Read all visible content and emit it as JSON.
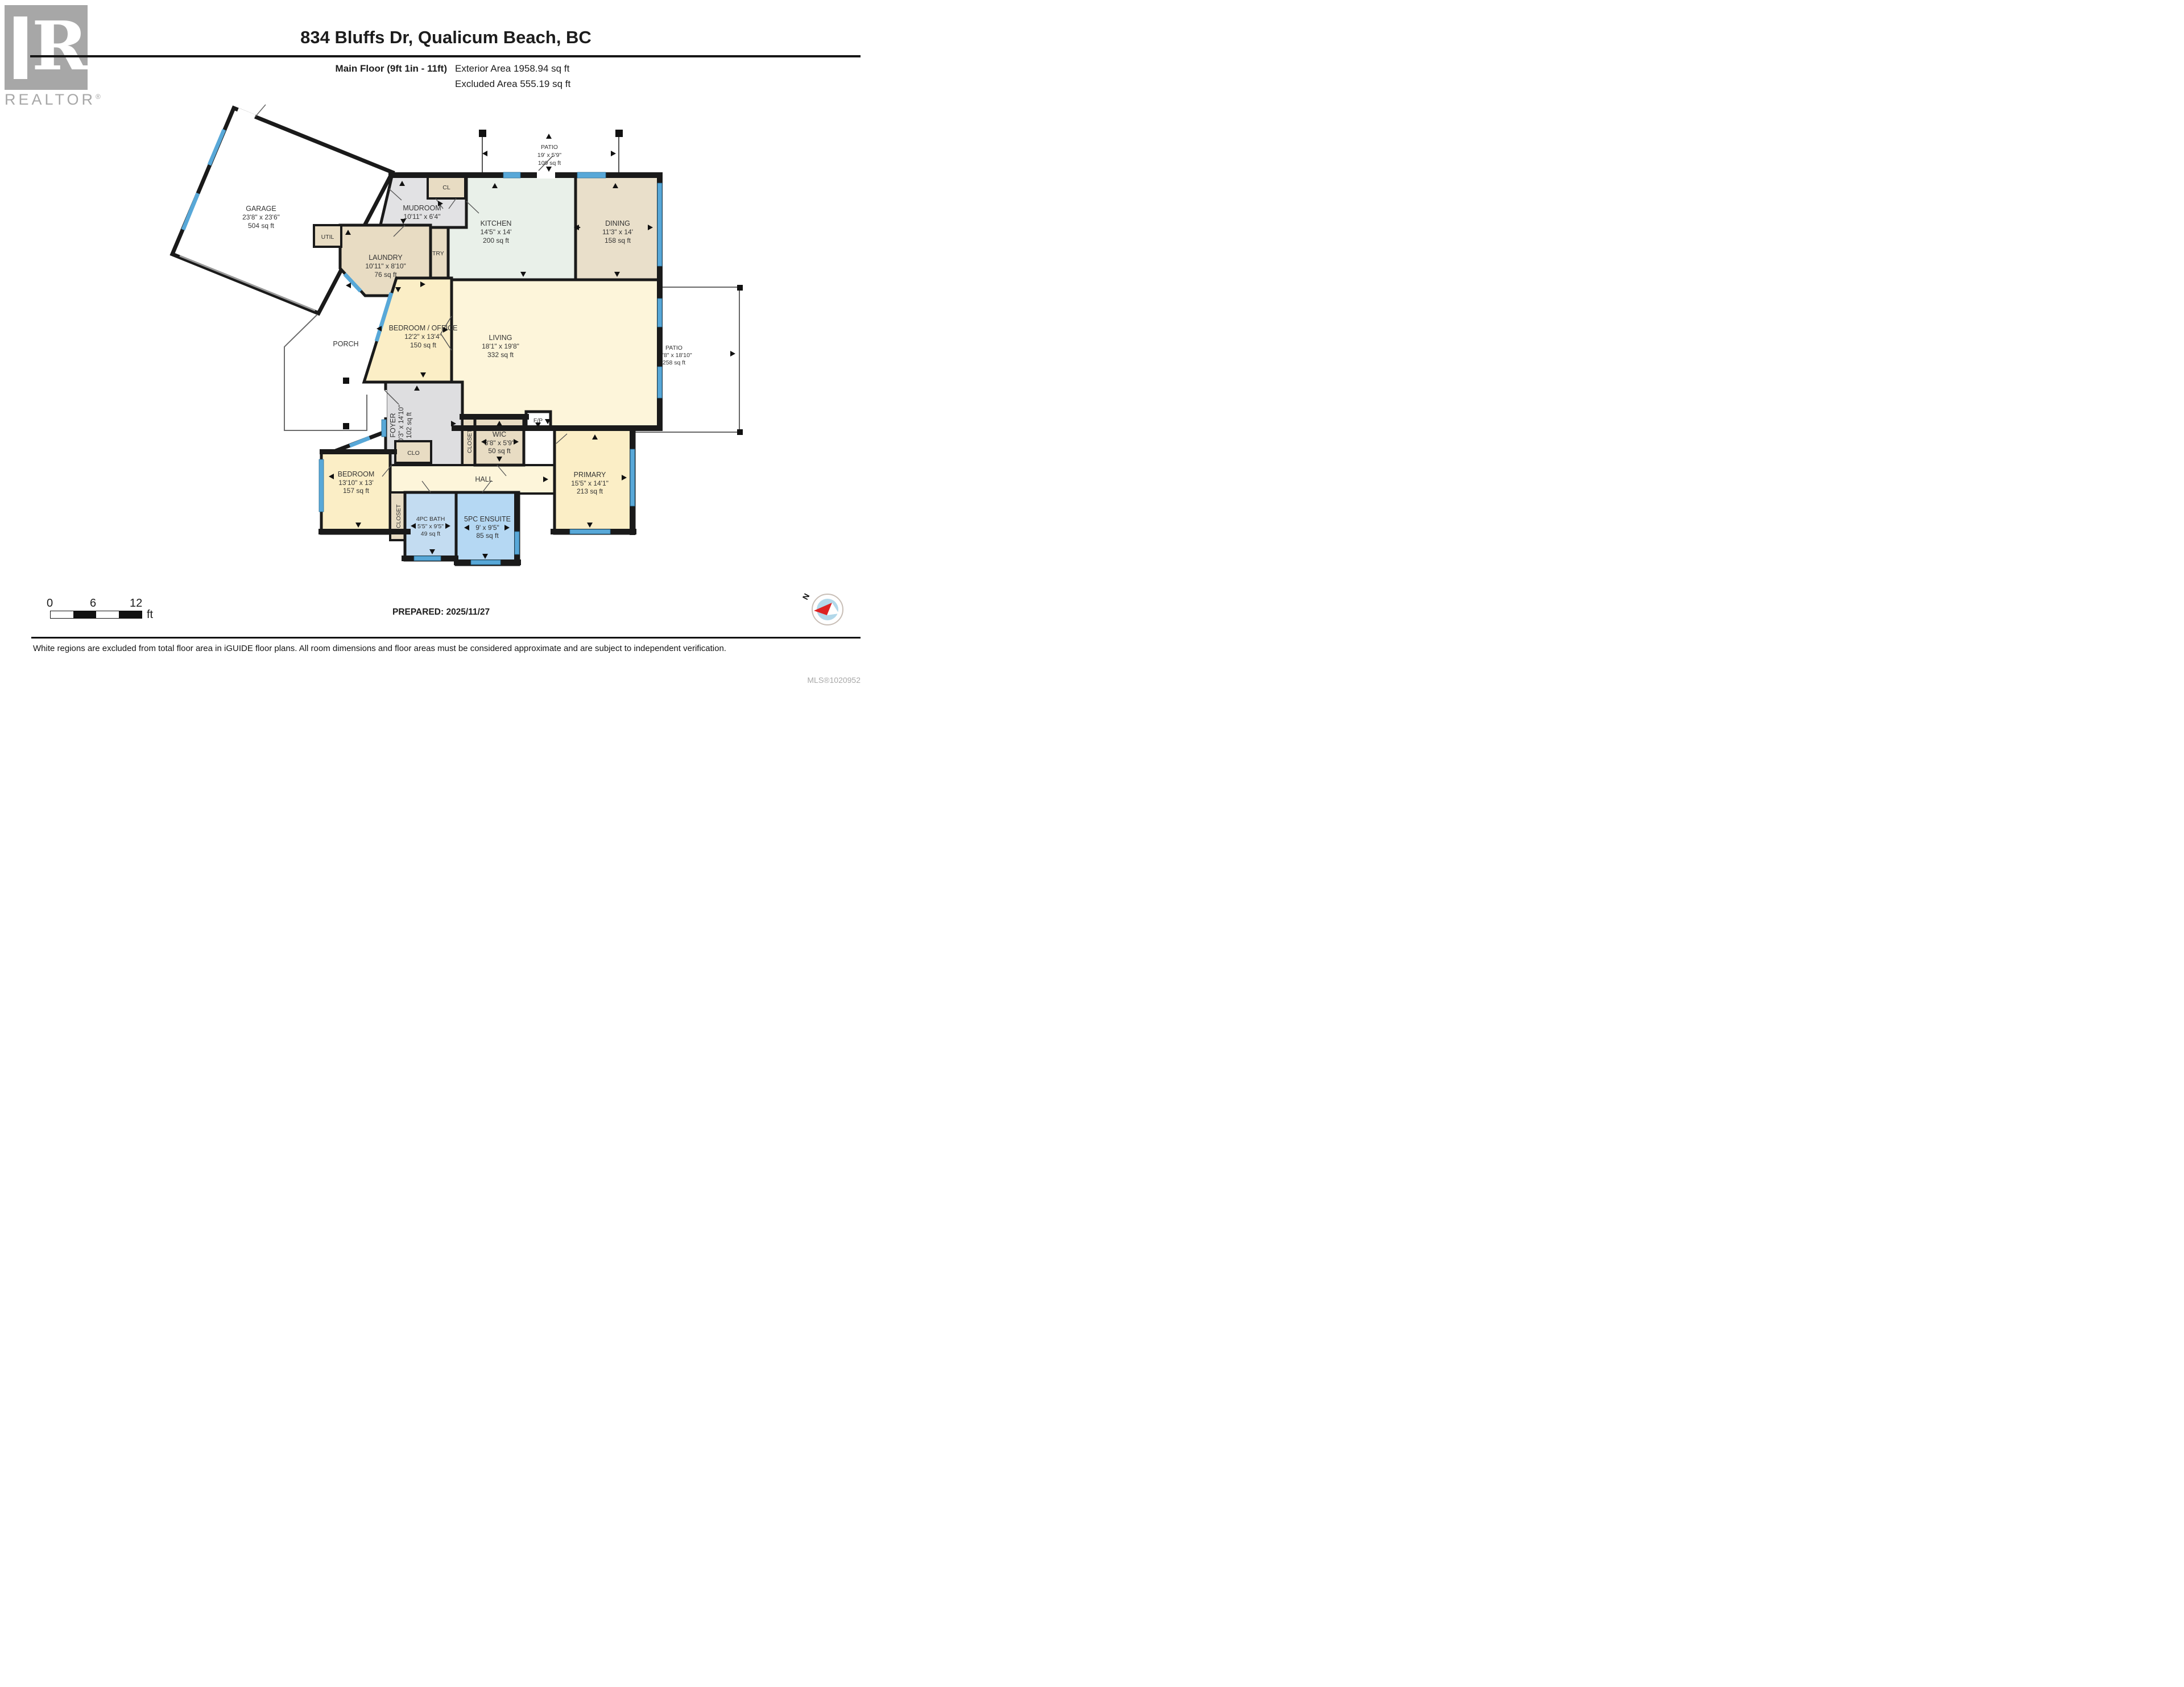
{
  "header": {
    "brand": "REALTOR",
    "brand_reg": "®",
    "brand_r": "R",
    "title": "834 Bluffs Dr, Qualicum Beach, BC",
    "floor_label": "Main Floor (9ft 1in - 11ft)",
    "exterior_area": "Exterior Area 1958.94 sq ft",
    "excluded_area": "Excluded Area 555.19 sq ft"
  },
  "plan": {
    "rooms": {
      "garage": {
        "name": "GARAGE",
        "dims": "23'8\" x 23'6\"",
        "area": "504 sq ft"
      },
      "patio_top": {
        "name": "PATIO",
        "dims": "19' x 5'9\"",
        "area": "109 sq ft"
      },
      "cl": {
        "name": "CL"
      },
      "mudroom": {
        "name": "MUDROOM",
        "dims": "10'11\" x 6'4\""
      },
      "kitchen": {
        "name": "KITCHEN",
        "dims": "14'5\" x 14'",
        "area": "200 sq ft"
      },
      "dining": {
        "name": "DINING",
        "dims": "11'3\" x 14'",
        "area": "158 sq ft"
      },
      "util": {
        "name": "UTIL"
      },
      "laundry": {
        "name": "LAUNDRY",
        "dims": "10'11\" x 8'10\"",
        "area": "76 sq ft"
      },
      "pantry": {
        "name": "PANTRY"
      },
      "bedroom_office": {
        "name": "BEDROOM / OFFICE",
        "dims": "12'2\" x 13'4\"",
        "area": "150 sq ft"
      },
      "living": {
        "name": "LIVING",
        "dims": "18'1\" x 19'8\"",
        "area": "332 sq ft"
      },
      "porch": {
        "name": "PORCH"
      },
      "patio_right": {
        "name": "PATIO",
        "dims": "13'8\" x 18'10\"",
        "area": "258 sq ft"
      },
      "foyer": {
        "name": "FOYER",
        "dims": "10'3\" x 14'10\"",
        "area": "102 sq ft"
      },
      "closet_wic": {
        "name": "CLOSET"
      },
      "wic": {
        "name": "WIC",
        "dims": "8'8\" x 5'9\"",
        "area": "50 sq ft"
      },
      "fp": {
        "name": "F/P"
      },
      "hall": {
        "name": "HALL"
      },
      "clo": {
        "name": "CLO"
      },
      "primary": {
        "name": "PRIMARY",
        "dims": "15'5\" x 14'1\"",
        "area": "213 sq ft"
      },
      "bedroom": {
        "name": "BEDROOM",
        "dims": "13'10\" x 13'",
        "area": "157 sq ft"
      },
      "closet_bath": {
        "name": "CLOSET"
      },
      "bath": {
        "name": "4PC BATH",
        "dims": "5'5\" x 9'5\"",
        "area": "49 sq ft"
      },
      "ensuite": {
        "name": "5PC ENSUITE",
        "dims": "9' x 9'5\"",
        "area": "85 sq ft"
      }
    },
    "colors": {
      "wall": "#1a1a1a",
      "window": "#58a8d8",
      "room_tan": "#e8dcc3",
      "room_gray": "#e2e2e4",
      "room_yellow": "#fbeec6",
      "room_cream": "#fdf5da",
      "room_green": "#e9f0e9",
      "room_blue": "#b5d8f3",
      "room_lightblue": "#c3dcf1",
      "compass_red": "#dd2222"
    }
  },
  "footer": {
    "scale": {
      "t0": "0",
      "t6": "6",
      "t12": "12",
      "unit": "ft"
    },
    "prepared": "PREPARED: 2025/11/27",
    "compass_n": "N",
    "disclaimer": "White regions are excluded from total floor area in iGUIDE floor plans. All room dimensions and floor areas must be considered approximate and are subject to independent verification.",
    "mls": "MLS®1020952"
  }
}
